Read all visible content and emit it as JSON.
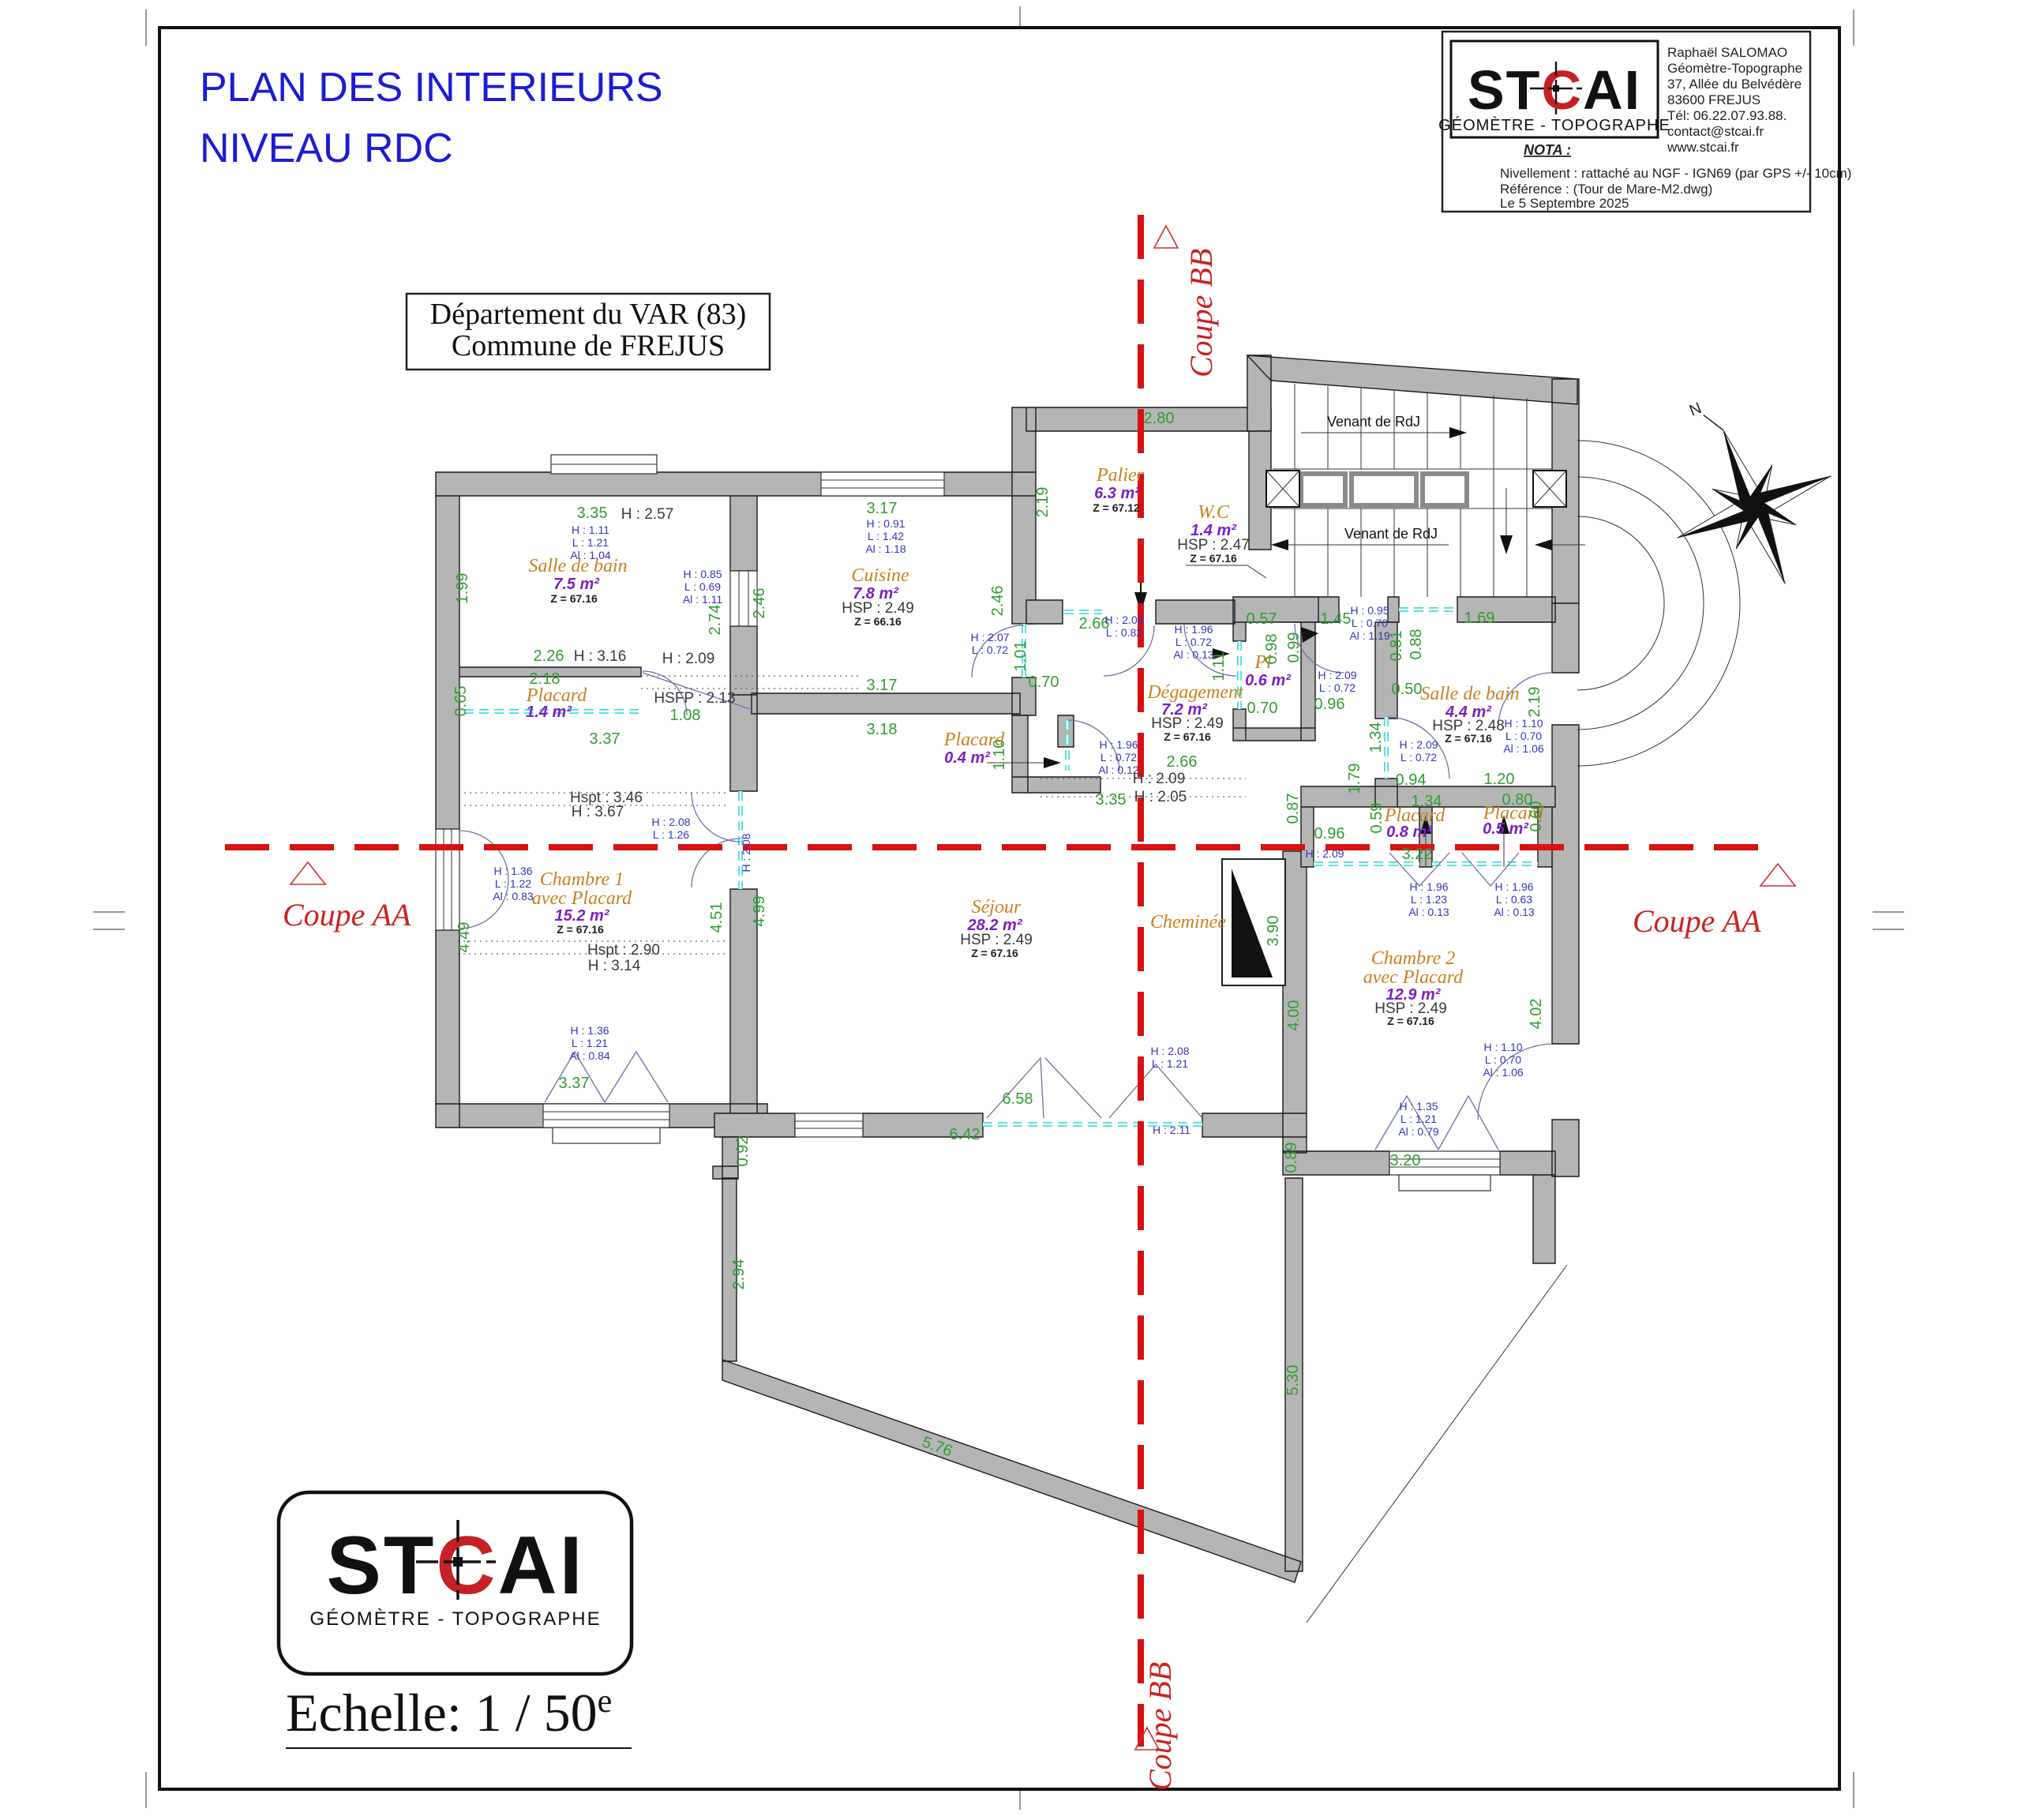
{
  "sheet": {
    "title_line1": "PLAN DES INTERIEURS",
    "title_line2": "NIVEAU RDC",
    "location_line1": "Département du VAR (83)",
    "location_line2": "Commune de  FREJUS",
    "scale_label": "Echelle: 1 / 50",
    "scale_sup": "e"
  },
  "brand": {
    "logo_st": "ST",
    "logo_c": "C",
    "logo_ai": "AI",
    "logo_subtitle": "GÉOMÈTRE - TOPOGRAPHE"
  },
  "info_box": {
    "contact_lines": [
      "Raphaël SALOMAO",
      "Géomètre-Topographe",
      "37, Allée du Belvédère",
      "83600 FREJUS",
      "Tél: 06.22.07.93.88.",
      "contact@stcai.fr",
      "www.stcai.fr"
    ],
    "nota_label": "NOTA :",
    "nota_line1": "Nivellement : rattaché au NGF - IGN69 (par GPS +/- 10cm)",
    "nota_line2": "Référence : (Tour de Mare-M2.dwg)",
    "date": "Le 5 Septembre 2025"
  },
  "sections": {
    "coupe_aa": "Coupe AA",
    "coupe_bb": "Coupe BB"
  },
  "compass": {
    "north": "N"
  },
  "stairs": {
    "label_top": "Venant de RdJ",
    "label_bottom": "Venant de RdJ"
  },
  "rooms": {
    "sdb1": {
      "name": "Salle de bain",
      "area": "7.5 m²",
      "z": "Z = 67.16"
    },
    "placard1": {
      "name": "Placard",
      "area": "1.4 m²"
    },
    "cuisine": {
      "name": "Cuisine",
      "area": "7.8 m²",
      "hsp": "HSP  :  2.49",
      "z": "Z = 66.16"
    },
    "palier": {
      "name": "Palier",
      "area": "6.3 m²",
      "z": "Z = 67.12"
    },
    "wc": {
      "name": "W.C",
      "area": "1.4 m²",
      "hsp": "HSP  :  2.47",
      "z": "Z = 67.16"
    },
    "degagement": {
      "name": "Dégagement",
      "area": "7.2 m²",
      "hsp": "HSP  :  2.49",
      "z": "Z = 67.16"
    },
    "pl": {
      "name": "Pl",
      "area": "0.6 m²"
    },
    "placard04": {
      "name": "Placard",
      "area": "0.4 m²"
    },
    "sdb2": {
      "name": "Salle de bain",
      "area": "4.4 m²",
      "hsp": "HSP  :  2.48",
      "z": "Z = 67.16"
    },
    "placard08": {
      "name": "Placard",
      "area": "0.8 m²"
    },
    "placard05": {
      "name": "Placard",
      "area": "0.5 m²"
    },
    "chambre1": {
      "name_line1": "Chambre 1",
      "name_line2": "avec Placard",
      "area": "15.2 m²",
      "z": "Z = 67.16"
    },
    "sejour": {
      "name": "Séjour",
      "area": "28.2 m²",
      "hsp": "HSP  :  2.49",
      "z": "Z = 67.16"
    },
    "cheminee": {
      "name": "Cheminée"
    },
    "chambre2": {
      "name_line1": "Chambre 2",
      "name_line2": "avec Placard",
      "area": "12.9 m²",
      "hsp": "HSP  :  2.49",
      "z": "Z = 67.16"
    }
  },
  "dims_green": {
    "g335a": "3.35",
    "g199": "1.99",
    "g274": "2.74",
    "g226": "2.26",
    "g218": "2.18",
    "g065": "0.65",
    "g108": "1.08",
    "g337a": "3.37",
    "g317a": "3.17",
    "g246a": "2.46",
    "g246b": "2.46",
    "g219a": "2.19",
    "g101": "1.01",
    "g070a": "0.70",
    "g317b": "3.17",
    "g318": "3.18",
    "g280": "2.80",
    "g266a": "2.66",
    "g057": "0.57",
    "g145": "1.45",
    "g098": "0.98",
    "g099": "0.99",
    "g081": "0.81",
    "g088": "0.88",
    "g111": "1.11",
    "g050": "0.50",
    "g096a": "0.96",
    "g070b": "0.70",
    "g134a": "1.34",
    "g266b": "2.66",
    "g179": "1.79",
    "g094": "0.94",
    "g087": "0.87",
    "g096b": "0.96",
    "g059": "0.59",
    "g134b": "1.34",
    "g322": "3.22",
    "g169": "1.69",
    "g219c": "2.19",
    "g120": "1.20",
    "g080": "0.80",
    "g060": "0.60",
    "g110": "1.10",
    "g335b": "3.35",
    "g449": "4.49",
    "g451": "4.51",
    "g499": "4.99",
    "g337b": "3.37",
    "g658": "6.58",
    "g642": "6.42",
    "g390": "3.90",
    "g400": "4.00",
    "g402": "4.02",
    "g320": "3.20",
    "g092": "0.92",
    "g294": "2.94",
    "g576": "5.76",
    "g530": "5.30",
    "g089": "0.89"
  },
  "specs_blue": {
    "sdb1_top": [
      "H : 1.11",
      "L : 1.21",
      "Al : 1.04"
    ],
    "sdb1_right": [
      "H : 0.85",
      "L : 0.69",
      "Al : 1.11"
    ],
    "cuisine_top": [
      "H : 0.91",
      "L : 1.42",
      "Al : 1.18"
    ],
    "cuisine_door": [
      "H : 2.07",
      "L : 0.72"
    ],
    "palier_win": [
      "H : 2.08",
      "L : 0.82"
    ],
    "palier_door": [
      "H : 1.96",
      "L : 0.72",
      "Al : 0.13"
    ],
    "sdb2_win": [
      "H : 0.95",
      "L : 0.70",
      "Al : 1.19"
    ],
    "pl_door": [
      "H : 2.09",
      "L : 0.72"
    ],
    "sdb2_door": [
      "H : 2.09",
      "L : 0.72"
    ],
    "p04_door": [
      "H : 1.96",
      "L : 0.72",
      "Al : 0.12"
    ],
    "ch2_pass": [
      "H : 2.09"
    ],
    "hall_door": [
      "H : 2.08",
      "L : 1.26"
    ],
    "hall_door_rot": [
      "H : 2.08"
    ],
    "entry_door": [
      "H : 1.36",
      "L : 1.22",
      "Al : 0.83"
    ],
    "ch1_win": [
      "H : 1.36",
      "L : 1.21",
      "Al : 0.84"
    ],
    "sejour_door": [
      "H : 2.08",
      "L : 1.21"
    ],
    "sejour_h": [
      "H : 2.11"
    ],
    "ch2_plc1": [
      "H : 1.96",
      "L : 1.23",
      "Al : 0.13"
    ],
    "ch2_plc2": [
      "H : 1.96",
      "L : 0.63",
      "Al : 0.13"
    ],
    "ch2_ext": [
      "H : 1.10",
      "L : 0.70",
      "Al : 1.06"
    ],
    "sdb2_ext": [
      "H : 1.10",
      "L : 0.70",
      "Al : 1.06"
    ],
    "ch2_win": [
      "H : 1.35",
      "L : 1.21",
      "Al : 0.79"
    ]
  },
  "heights_black": {
    "sdb1_h": "H  :  2.57",
    "sdb1_h2": "H  :  3.16",
    "sdb1_h3": "H  :  2.09",
    "hsfp": "HSFP  :  2.13",
    "deg_h1": "H  :  2.09",
    "deg_h2": "H  :  2.05",
    "hall_hspt": "Hspt  :  3.46",
    "hall_h": "H  :  3.67",
    "ch1_hspt": "Hspt  :  2.90",
    "ch1_h": "H  :  3.14"
  },
  "colors": {
    "dim_green": "#2f9e31",
    "spec_blue": "#3535bb",
    "room_orange": "#c8821e",
    "area_purple": "#7b1fc4",
    "section_red": "#d81111",
    "wall_gray": "#b5b5b5",
    "window_cyan": "#49dede",
    "title_blue": "#1b1bd6",
    "logo_red": "#c42025"
  }
}
